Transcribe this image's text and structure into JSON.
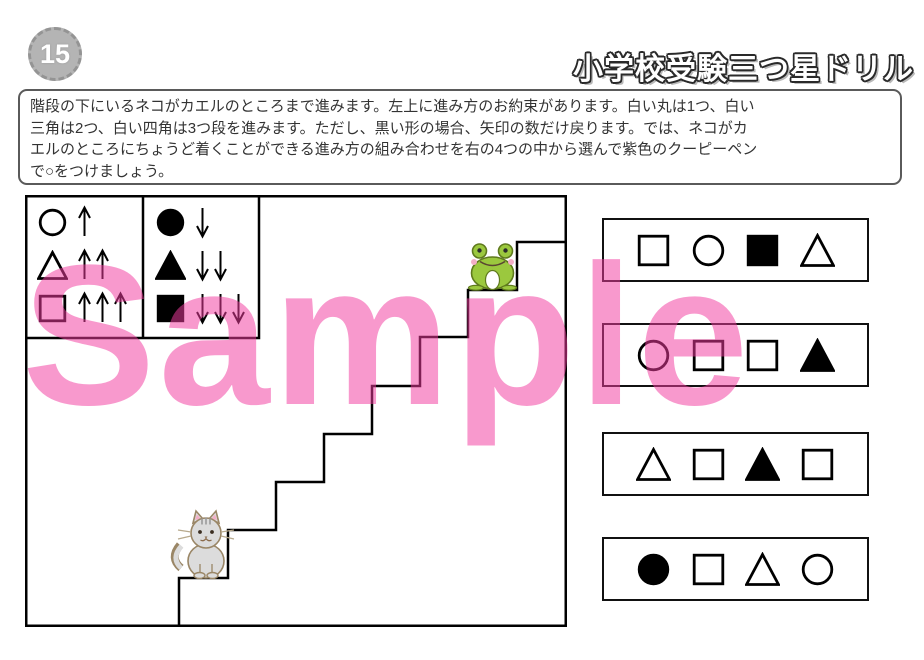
{
  "page": {
    "badge_number": "15",
    "title": "小学校受験三つ星ドリル",
    "watermark": "Sample"
  },
  "instruction": {
    "lines": [
      "階段の下にいるネコがカエルのところまで進みます。左上に進み方のお約束があります。白い丸は1つ、白い",
      "三角は2つ、白い四角は3つ段を進みます。ただし、黒い形の場合、矢印の数だけ戻ります。では、ネコがカ",
      "エルのところにちょうど着くことができる進み方の組み合わせを右の4つの中から選んで紫色のクーピーペン",
      "で○をつけましょう。"
    ],
    "full_text": "階段の下にいるネコがカエルのところまで進みます。左上に進み方のお約束があります。白い丸は1つ、白い三角は2つ、白い四角は3つ段を進みます。ただし、黒い形の場合、矢印の数だけ戻ります。では、ネコがカエルのところにちょうど着くことができる進み方の組み合わせを右の4つの中から選んで紫色のクーピーペンで○をつけましょう。"
  },
  "legend": {
    "up_rules": [
      {
        "shape": "white-circle",
        "arrows": "↑",
        "steps": 1,
        "direction": "up"
      },
      {
        "shape": "white-triangle",
        "arrows": "↑↑",
        "steps": 2,
        "direction": "up"
      },
      {
        "shape": "white-square",
        "arrows": "↑↑↑",
        "steps": 3,
        "direction": "up"
      }
    ],
    "down_rules": [
      {
        "shape": "black-circle",
        "arrows": "↓",
        "steps": 1,
        "direction": "down"
      },
      {
        "shape": "black-triangle",
        "arrows": "↓↓",
        "steps": 2,
        "direction": "down"
      },
      {
        "shape": "black-square",
        "arrows": "↓↓↓",
        "steps": 3,
        "direction": "down"
      }
    ]
  },
  "diagram": {
    "characters": [
      {
        "name": "cat",
        "position": "bottom-of-stairs"
      },
      {
        "name": "frog",
        "position": "top-of-stairs"
      }
    ],
    "stairs_polyline": [
      [
        154,
        430
      ],
      [
        154,
        383
      ],
      [
        203,
        383
      ],
      [
        203,
        335
      ],
      [
        251,
        335
      ],
      [
        251,
        287
      ],
      [
        299,
        287
      ],
      [
        299,
        239
      ],
      [
        347,
        239
      ],
      [
        347,
        191
      ],
      [
        395,
        191
      ],
      [
        395,
        142
      ],
      [
        443,
        142
      ],
      [
        443,
        95
      ],
      [
        492,
        95
      ],
      [
        492,
        47
      ],
      [
        540,
        47
      ]
    ]
  },
  "options": [
    {
      "shapes": [
        "white-square",
        "white-circle",
        "black-square",
        "white-triangle"
      ]
    },
    {
      "shapes": [
        "white-circle",
        "white-square",
        "white-square",
        "black-triangle"
      ]
    },
    {
      "shapes": [
        "white-triangle",
        "white-square",
        "black-triangle",
        "white-square"
      ]
    },
    {
      "shapes": [
        "black-circle",
        "white-square",
        "white-triangle",
        "white-circle"
      ]
    }
  ],
  "colors": {
    "watermark_pink": "#F23CA0",
    "frog_green": "#9BC83E",
    "cat_gray": "#DCDCDC",
    "badge_gray": "#B4B4B4"
  }
}
